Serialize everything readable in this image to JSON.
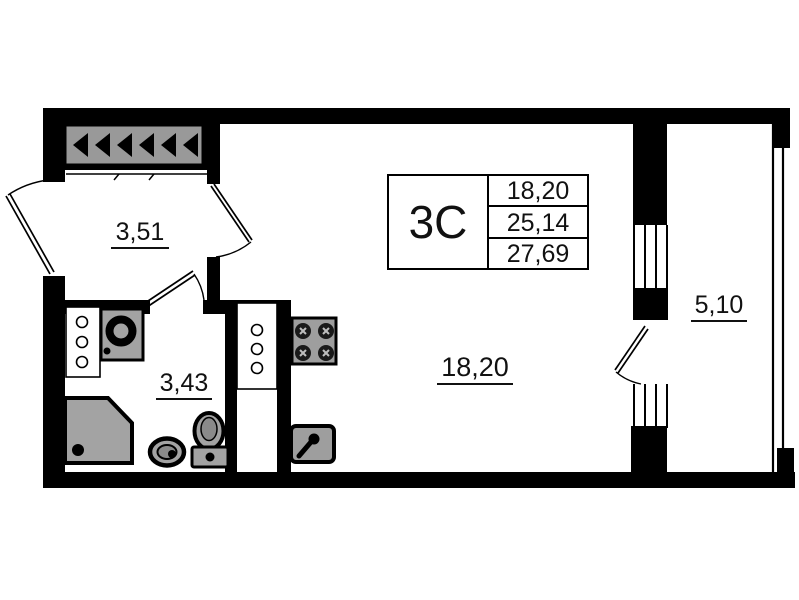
{
  "floor_plan": {
    "unit": {
      "type_label": "3С",
      "area_rows": [
        "18,20",
        "25,14",
        "27,69"
      ]
    },
    "rooms": {
      "hallway": {
        "area": "3,51"
      },
      "bathroom": {
        "area": "3,43"
      },
      "living_room": {
        "area": "18,20"
      },
      "balcony": {
        "area": "5,10"
      }
    },
    "colors": {
      "walls": "#000000",
      "fixtures": "#a3a3a3",
      "vent_panel": "#999999",
      "background": "#ffffff"
    }
  }
}
